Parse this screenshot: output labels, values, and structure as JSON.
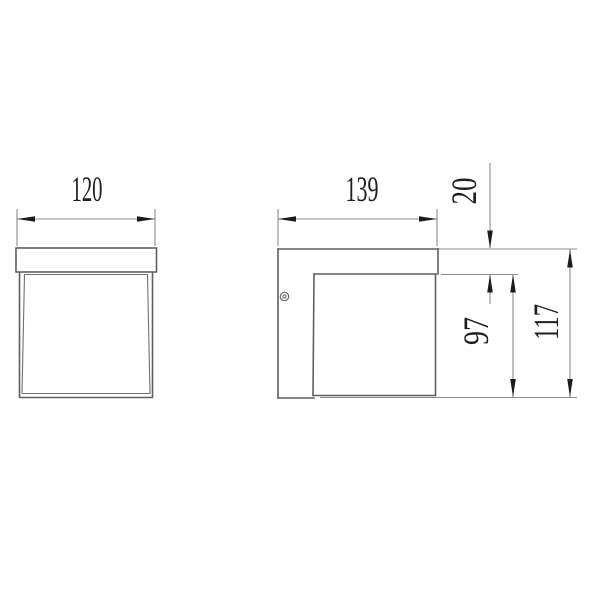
{
  "drawing": {
    "kind": "technical dimension drawing, wall lamp, two orthographic views",
    "views": {
      "front": {
        "name": "front view",
        "width_dim": {
          "value": "120",
          "orientation": "horizontal"
        }
      },
      "side": {
        "name": "side view",
        "depth_dim": {
          "value": "139",
          "orientation": "horizontal"
        },
        "top_inset_dim": {
          "value": "20",
          "orientation": "vertical"
        },
        "body_height_dim": {
          "value": "97",
          "orientation": "vertical"
        },
        "total_height_dim": {
          "value": "117",
          "orientation": "vertical"
        }
      }
    },
    "markers": {
      "screw": "screw-head symbol on side view mounting plate"
    },
    "colors": {
      "background": "#ffffff",
      "outline": "#5f5f5f",
      "dimension_line": "#8c8c8c",
      "text": "#1f1f1f",
      "arrow": "#1c1c1c"
    }
  }
}
